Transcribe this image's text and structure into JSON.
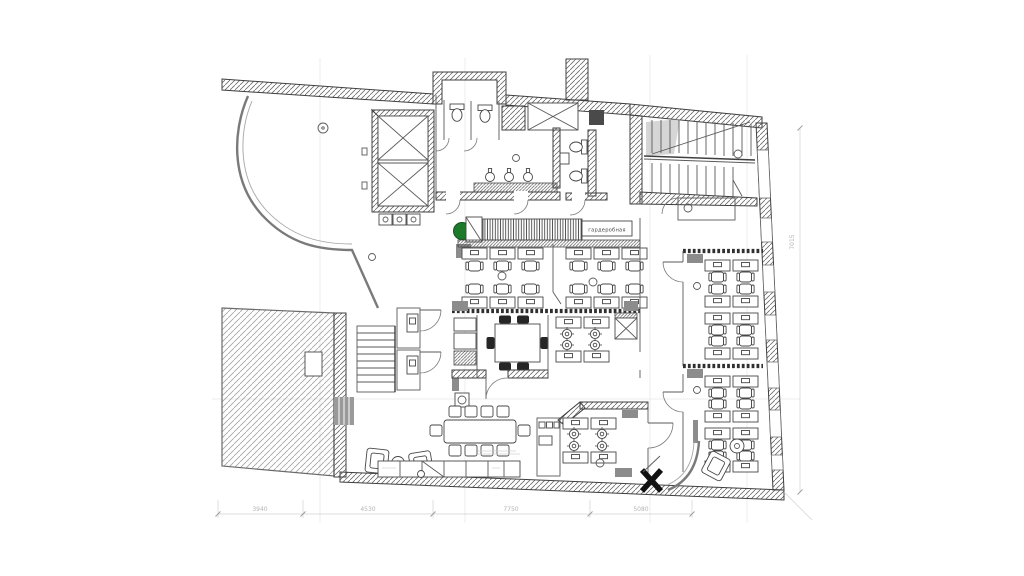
{
  "meta": {
    "type": "architectural-floor-plan",
    "description": "Office level floor plan with open office areas, meeting room, WC block, two staircases and elevator"
  },
  "labels": {
    "wardrobe": "гардеробная"
  },
  "dimensions": {
    "bottom": [
      "3940",
      "4530",
      "7750",
      "5080"
    ],
    "right": [
      "7015"
    ]
  },
  "colors": {
    "background": "#ffffff",
    "wall_line": "#3f3f3f",
    "hatch": "#6b6b6b",
    "light_hatch": "#a3a3a3",
    "gray_fill": "#8c8c8c",
    "dark_fill": "#262626",
    "plant_green": "#1d7a2b",
    "dim_text": "#b4b4b4"
  }
}
